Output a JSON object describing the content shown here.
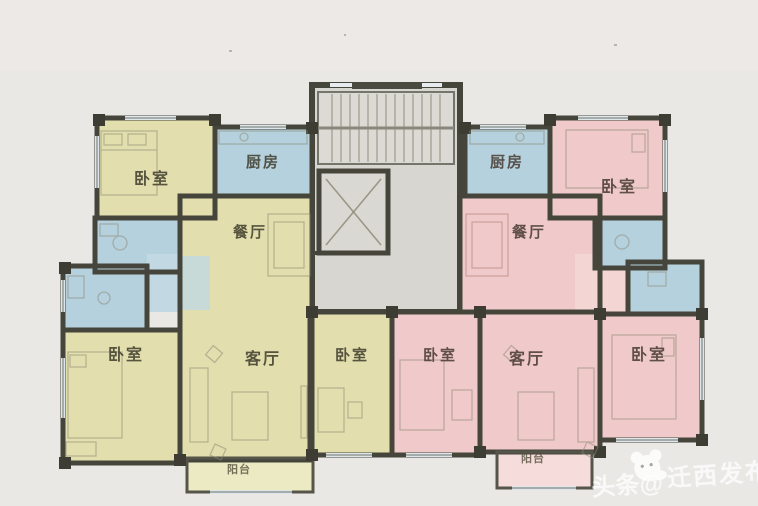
{
  "plan": {
    "type": "residential-floor-plan",
    "description": "Two mirrored apartment units around a central stair and elevator core",
    "rooms": {
      "left_bedroom_top": "卧室",
      "left_kitchen": "厨房",
      "left_dining": "餐厅",
      "left_bedroom_bottom": "卧室",
      "left_living": "客厅",
      "left_bedroom_mid": "卧室",
      "left_balcony": "阳台",
      "right_kitchen": "厨房",
      "right_bedroom_top": "卧室",
      "right_dining": "餐厅",
      "right_bedroom_mid": "卧室",
      "right_living": "客厅",
      "right_bedroom_bottom": "卧室",
      "right_balcony": "阳台"
    },
    "colors": {
      "left_unit_fill": "#e2deae",
      "right_unit_fill": "#f0caca",
      "wet_room_fill": "#b6d1de",
      "core_fill": "#d8d6d0",
      "wall": "#45453c",
      "background": "#eae8e4",
      "balcony_left_fill": "#eceac2",
      "balcony_right_fill": "#f6dcda"
    },
    "watermark": {
      "prefix": "头条@",
      "name": "迁西发布"
    }
  }
}
